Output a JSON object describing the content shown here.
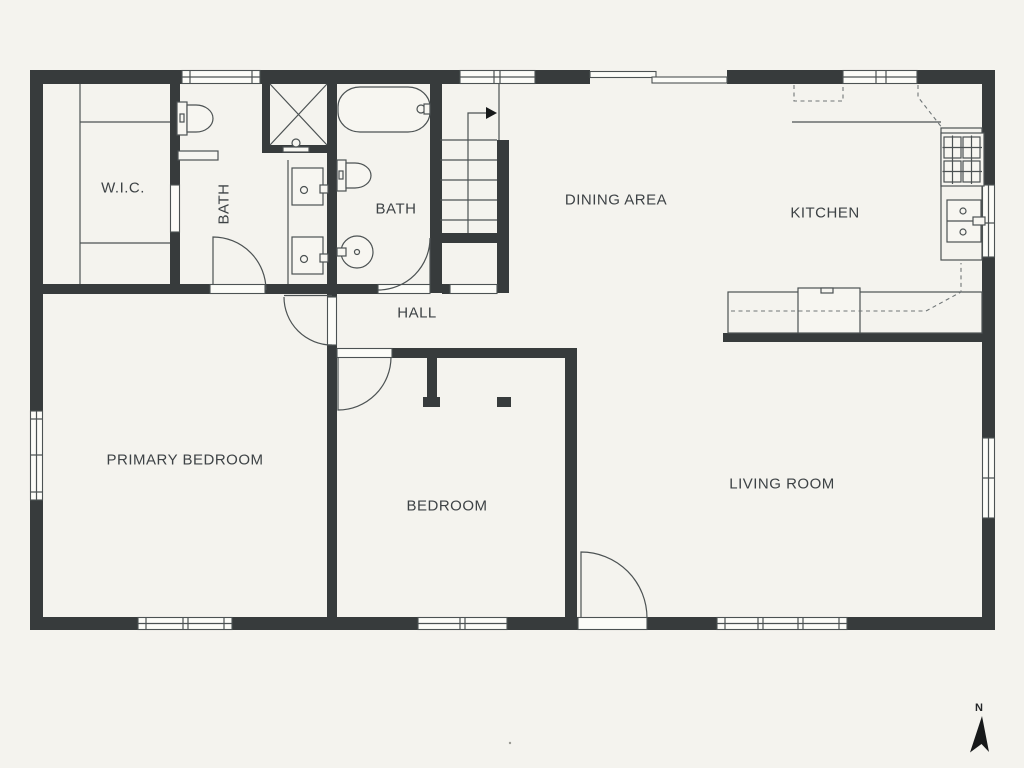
{
  "colors": {
    "bg": "#f4f3ee",
    "wall": "#373b3c",
    "line": "#4c5253",
    "label": "#3d4245",
    "dash": "#707677"
  },
  "rooms": [
    {
      "id": "wic",
      "label": "W.I.C."
    },
    {
      "id": "bath-1",
      "label": "BATH"
    },
    {
      "id": "bath-2",
      "label": "BATH"
    },
    {
      "id": "hall",
      "label": "HALL"
    },
    {
      "id": "dining-area",
      "label": "DINING AREA"
    },
    {
      "id": "kitchen",
      "label": "KITCHEN"
    },
    {
      "id": "primary-bedroom",
      "label": "PRIMARY BEDROOM"
    },
    {
      "id": "bedroom",
      "label": "BEDROOM"
    },
    {
      "id": "living-room",
      "label": "LIVING ROOM"
    }
  ],
  "compass": {
    "label": "N"
  }
}
